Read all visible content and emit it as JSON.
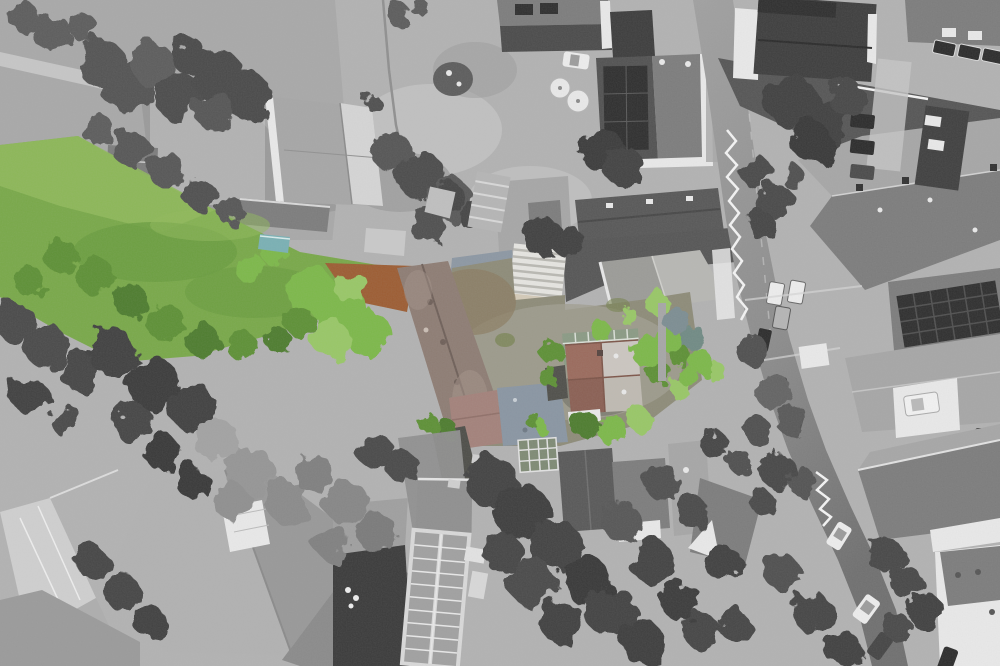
{
  "meta": {
    "kind": "aerial-drone-photograph",
    "description": "Top-down aerial photo of a village block; image is black-and-white except a selectively colorized diagonal band: a green meadow, trees, an old farm building with weathered brown roof, a courtyard and a small hip-roof house.",
    "width_px": 1000,
    "height_px": 666
  },
  "palette": {
    "grass_light": "#8fba5a",
    "grass": "#78a848",
    "grass_olive": "#699c3e",
    "foliage_bright": "#7cb849",
    "foliage_highlight": "#98c766",
    "foliage_mid": "#5d9034",
    "foliage_dark": "#4d7c2f",
    "moss": "#76824f",
    "courtyard": "#8d8b78",
    "courtyard_light": "#a09e90",
    "courtyard_brown": "#8a7a5e",
    "roof_brown": "#8d7c73",
    "roof_brown_dark": "#6e5f58",
    "roof_rust": "#9c5c32",
    "roof_pink": "#a3817a",
    "roof_slate": "#8995a2",
    "pavement_blue": "#8c97a3",
    "roof_teal": "#79b0b4",
    "hip_red": "#9a6a5c",
    "hip_red_dark": "#8a5f53",
    "hip_white": "#cbc6c0",
    "hip_white_dark": "#bfbab2",
    "glass_green": "#8a9a84",
    "gray_base": "#b2b2b2",
    "ground": "#a8a8a8",
    "ground_light": "#c6c6c6",
    "ground_dark": "#9a9a9a",
    "tree_dark": "#454545",
    "tree_mid": "#5c5c5c",
    "tree_light": "#8f8f8f",
    "tree_pale": "#a2a2a2",
    "roof_dark": "#4a4a4a",
    "roof_mid": "#7c7c7c",
    "roof_light": "#a6a6a6",
    "roof_bright": "#d5d5d5",
    "wall_white": "#e9e9e9",
    "asphalt": "#555555",
    "asphalt_dark": "#3a3a3a",
    "road_gray": "#979797",
    "marking_white": "#f4f4f4",
    "car_dark": "#2b2b2b",
    "car_white": "#ededed",
    "solar_dark": "#2e2e2e"
  },
  "scene": {
    "colorized_regions": [
      "meadow",
      "hedge-and-trees",
      "farm-building-roof",
      "farm-courtyard",
      "hip-roof-house",
      "slate-roof",
      "blue-pavement",
      "garden-patch-by-road",
      "greenhouse"
    ],
    "grayscale_regions": [
      "top-left-farmstead",
      "top-center-yard-and-houses",
      "street-with-zigzag-marking",
      "right-terraced-houses",
      "solar-roof-buildings",
      "bottom-left-house-and-garages",
      "bottom-tree-band",
      "parked-cars"
    ]
  }
}
